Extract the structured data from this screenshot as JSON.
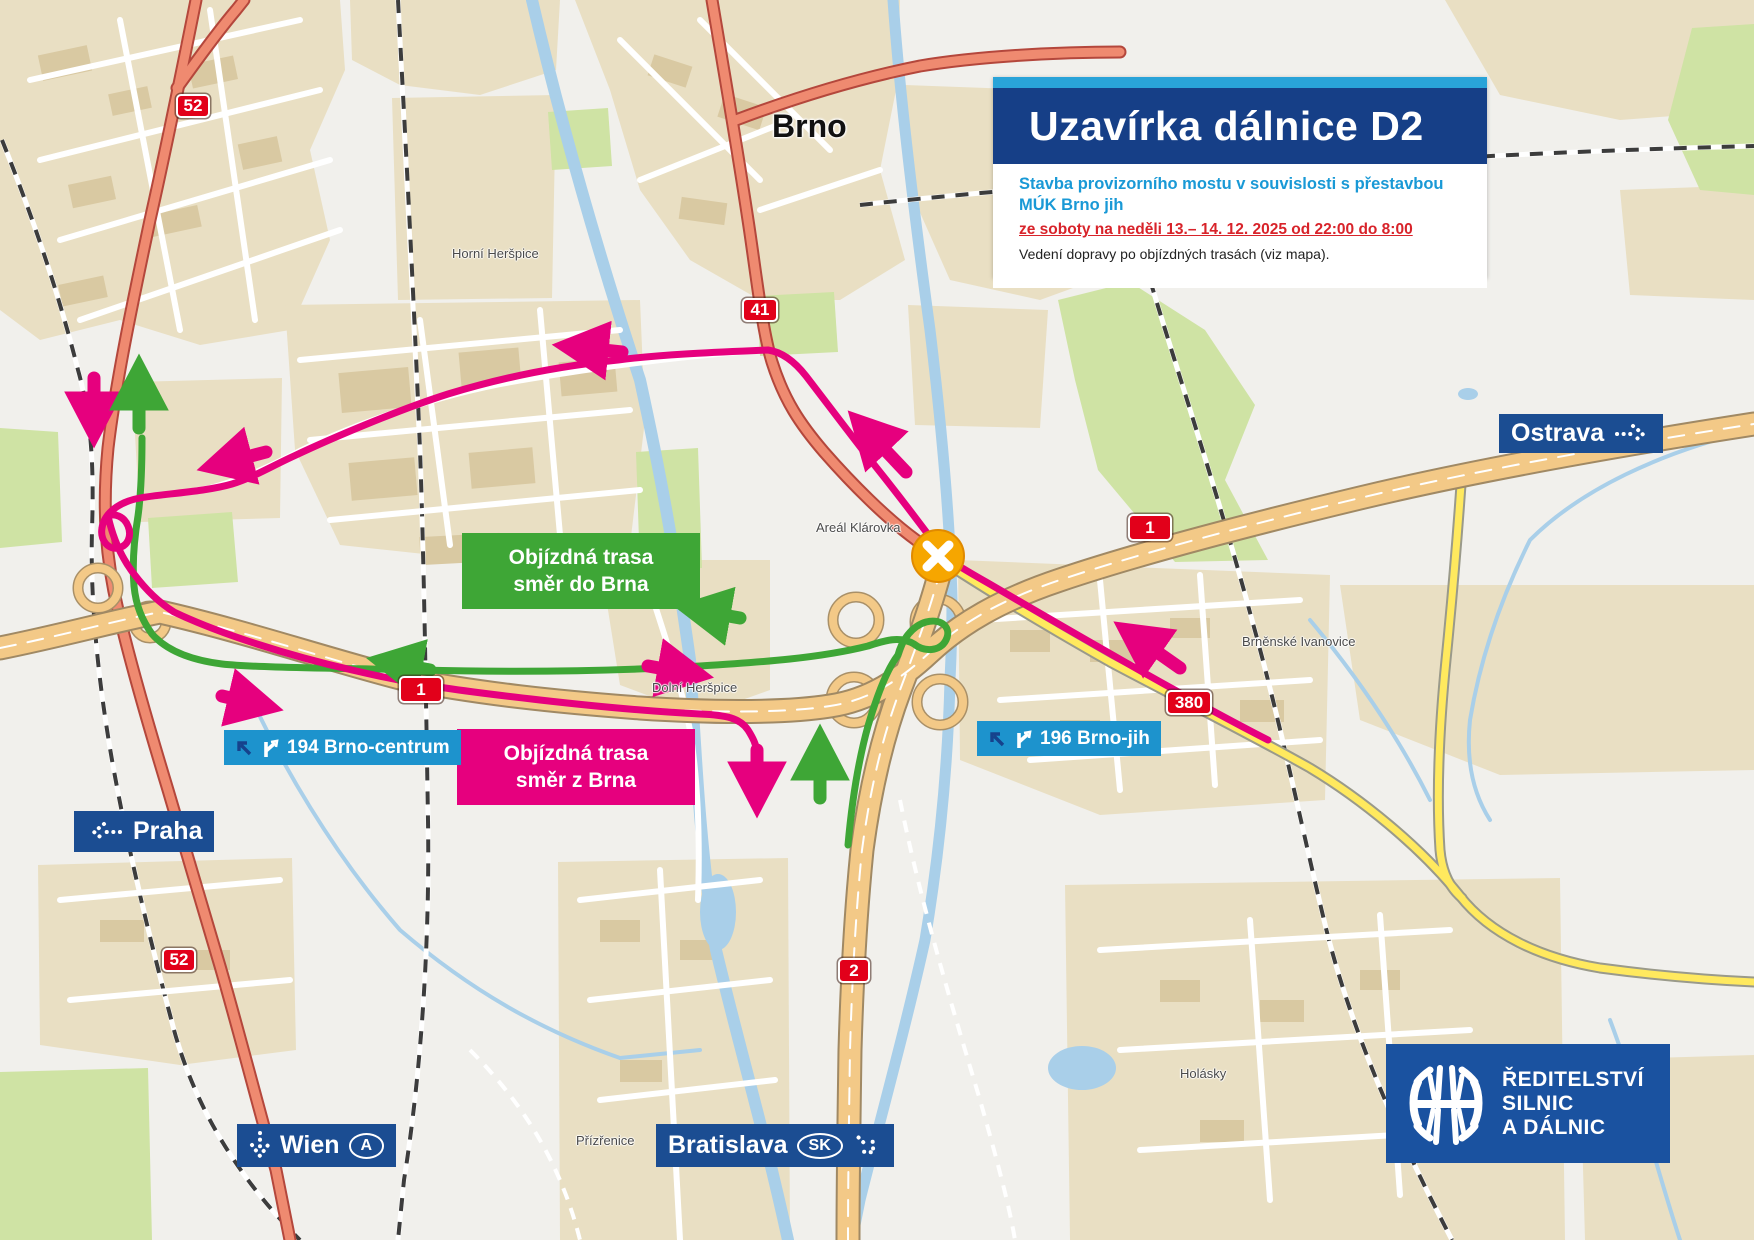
{
  "info_panel": {
    "title": "Uzavírka dálnice D2",
    "subtitle_line1": "Stavba provizorního mostu v souvislosti s přestavbou",
    "subtitle_line2": "MÚK Brno jih",
    "date_line": "ze soboty na neděli 13.– 14. 12. 2025 od 22:00 do 8:00",
    "note": "Vedení dopravy po objízdných trasách (viz mapa)."
  },
  "detour_boxes": {
    "to_brno": {
      "line1": "Objízdná trasa",
      "line2": "směr do Brna",
      "color": "#3EA636"
    },
    "from_brno": {
      "line1": "Objízdná trasa",
      "line2": "směr z Brna",
      "color": "#E6007E"
    }
  },
  "exit_labels": [
    {
      "label": "194 Brno-centrum"
    },
    {
      "label": "196 Brno-jih"
    }
  ],
  "direction_signs": {
    "ostrava": {
      "label": "Ostrava"
    },
    "praha": {
      "label": "Praha"
    },
    "wien": {
      "label": "Wien",
      "country_badge": "A"
    },
    "bratislava": {
      "label": "Bratislava",
      "country_badge": "SK"
    }
  },
  "road_badges": [
    {
      "label": "52"
    },
    {
      "label": "41"
    },
    {
      "label": "1"
    },
    {
      "label": "1"
    },
    {
      "label": "380"
    },
    {
      "label": "2"
    },
    {
      "label": "52"
    }
  ],
  "place_labels": {
    "city": "Brno",
    "horni_herspice": "Horní Heršpice",
    "dolni_herspice": "Dolní Heršpice",
    "areal_klarovka": "Areál Klárovka",
    "brnenske_ivanovice": "Brněnské Ivanovice",
    "holasky": "Holásky",
    "prizrenice": "Přízřenice"
  },
  "logo": {
    "line1": "ŘEDITELSTVÍ",
    "line2": "SILNIC",
    "line3": "A DÁLNIC"
  },
  "colors": {
    "navy": "#163F87",
    "accent_blue": "#29a3d8",
    "exit_blue": "#1d93cd",
    "closure_red_text": "#d8232a",
    "detour_magenta": "#E6007E",
    "detour_green": "#3EA636",
    "motorway_orange": "#f3c987",
    "road_salmon": "#ef8a70",
    "road_yellow": "#ffe95e",
    "badge_red": "#e2001a"
  }
}
